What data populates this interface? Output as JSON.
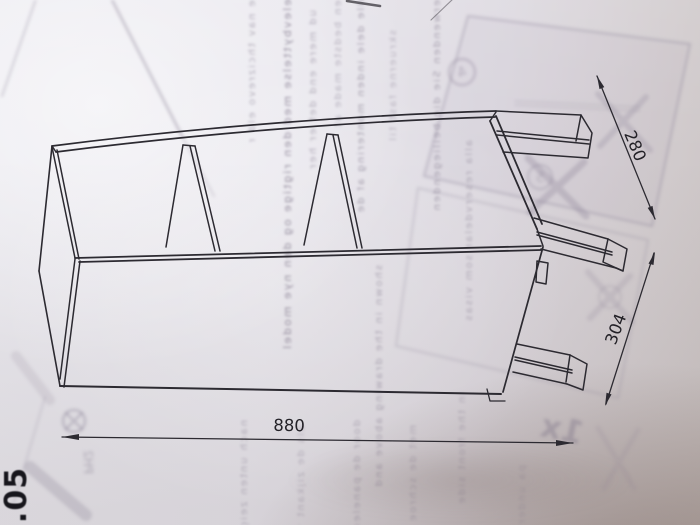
{
  "page": {
    "number": ".05"
  },
  "drawing": {
    "dimensions": {
      "length": "880",
      "depth": "304",
      "foot_span": "280"
    }
  },
  "ghost_bleedthrough": {
    "quantity": "1x",
    "tool": "PH2",
    "circled_marks": [
      "4",
      "5"
    ],
    "text_columns": [
      "ne nav thcizrevo eld nav",
      "nelevbyttelse med den rigtige og den nye model ser ud",
      "ud mere end det er her",
      "den bedste made at",
      "alle dele inden montering af de",
      "skruerne fast til",
      "verwenden Sie die beiliegenden",
      "alla reservdelar som visas",
      "shown in the drawing above and",
      "nach unten zeigt",
      "als de zijkant van",
      "door de panelen heen",
      "met de schroeven",
      "in the front side",
      "pa undersiden"
    ]
  }
}
